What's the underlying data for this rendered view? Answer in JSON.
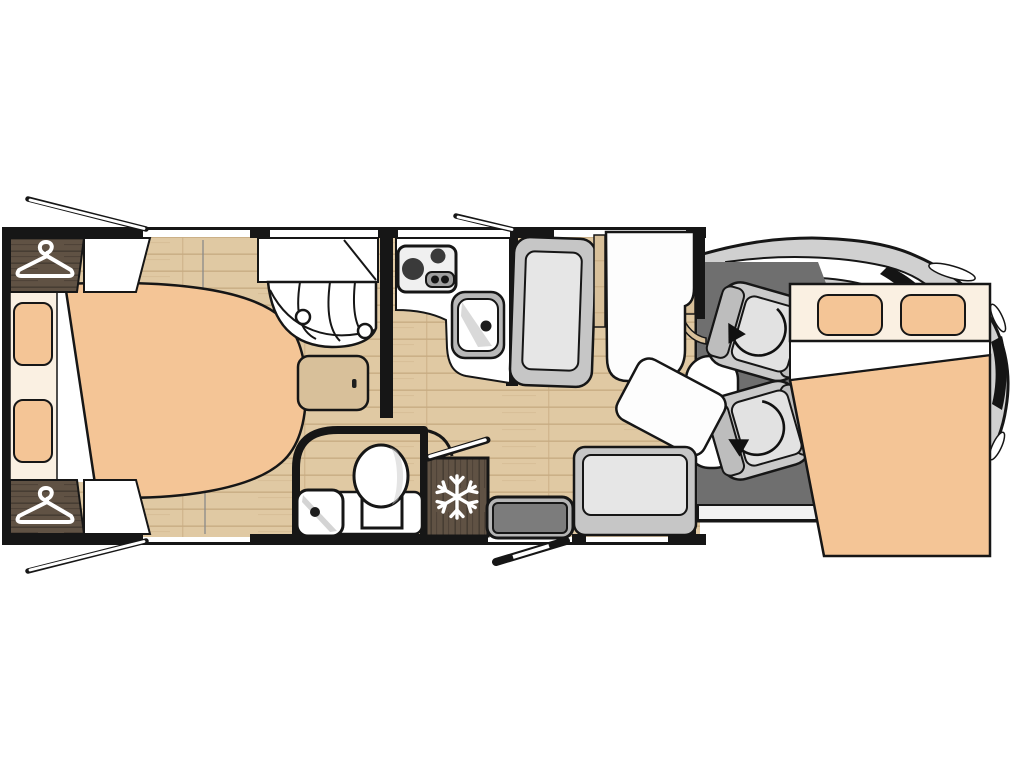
{
  "diagram": {
    "type": "motorhome-floorplan-top-view",
    "zones": [
      "rear-island-bed",
      "wardrobes",
      "shower",
      "washroom",
      "kitchen",
      "fridge",
      "entrance",
      "dinette",
      "cab-swivel-seats",
      "drop-down-bed"
    ]
  },
  "icons": {
    "hanger": "clothes-hanger-icon",
    "snowflake": "fridge-freezer-icon",
    "swivel_arrow": "seat-rotation-arrow-icon"
  },
  "colors": {
    "background": "#ffffff",
    "wall": "#161616",
    "floor_base": "#e0c9a3",
    "floor_line": "#c8ac82",
    "dark_wood": "#605244",
    "dark_wood_line": "#473d33",
    "light_wood": "#d8c09a",
    "bed_peach": "#f4c596",
    "bed_cream": "#faf0e2",
    "white": "#fdfdfd",
    "cab_floor": "#6f6f6f",
    "cab_body": "#d0d0d0",
    "cab_dark": "#141414",
    "seat_frame": "#c9c9c9",
    "seat_trim": "#bdbdbd",
    "seat_cushion": "#e2e2e2",
    "bench_frame": "#c6c6c6",
    "bench_cushion": "#e6e6e6",
    "step_outer": "#b5b5b5",
    "step_inner": "#7c7c7c",
    "hob_panel": "#f0f0f0",
    "hob_controls": "#a0a0a0",
    "burner": "#3a3a3a",
    "sink_rim": "#b9b9b9",
    "skirt": "#f2f2f2",
    "shade_gray": "#c9c9c9"
  }
}
